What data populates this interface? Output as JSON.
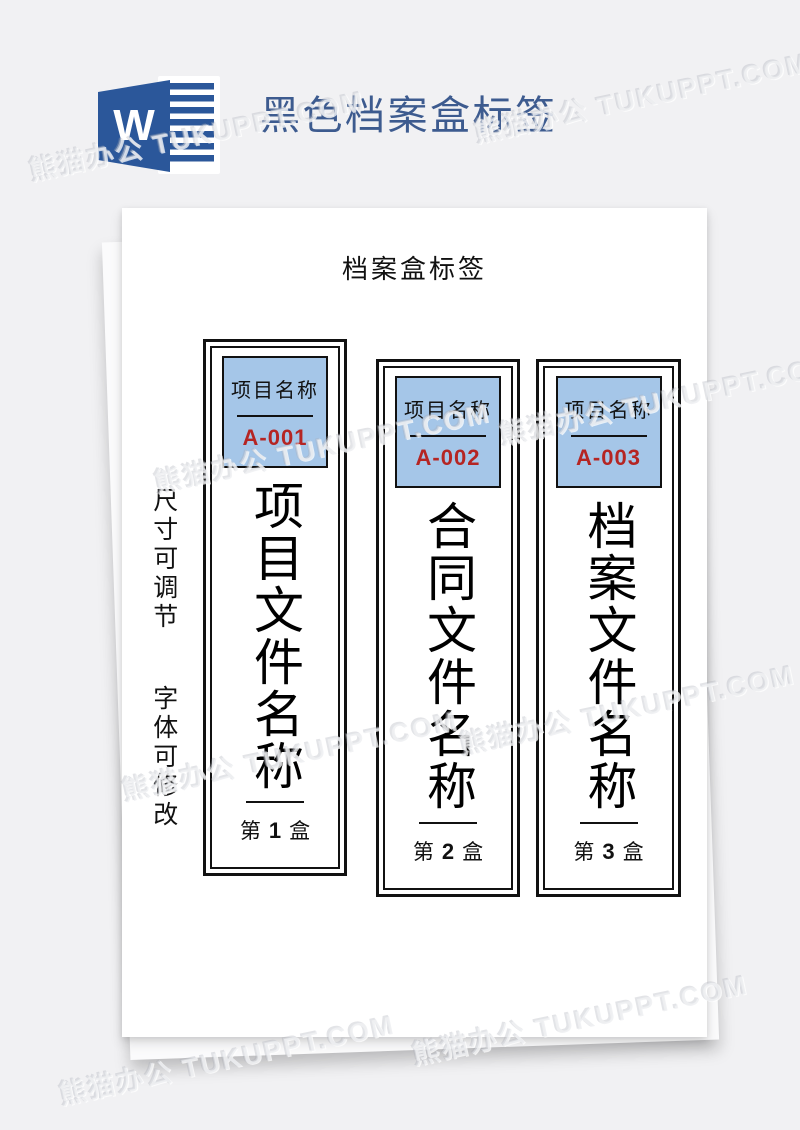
{
  "header": {
    "icon": "word-icon",
    "icon_letter": "W",
    "title": "黑色档案盒标签"
  },
  "watermark": {
    "text": "熊猫办公 TUKUPPT.COM",
    "instances": [
      {
        "x": 25,
        "y": 150,
        "rot": -12
      },
      {
        "x": 470,
        "y": 112,
        "rot": -12
      },
      {
        "x": 150,
        "y": 462,
        "rot": -12
      },
      {
        "x": 495,
        "y": 414,
        "rot": -12
      },
      {
        "x": 118,
        "y": 770,
        "rot": -12
      },
      {
        "x": 455,
        "y": 724,
        "rot": -12
      },
      {
        "x": 55,
        "y": 1074,
        "rot": -12
      },
      {
        "x": 408,
        "y": 1034,
        "rot": -12
      }
    ]
  },
  "document": {
    "page_title": "档案盒标签",
    "side_notes": [
      "尺寸可调节",
      "字体可修改"
    ],
    "labels": [
      {
        "header_title": "项目名称",
        "code": "A-001",
        "name": "项目文件名称",
        "box_prefix": "第",
        "box_number": "1",
        "box_suffix": "盒"
      },
      {
        "header_title": "项目名称",
        "code": "A-002",
        "name": "合同文件名称",
        "box_prefix": "第",
        "box_number": "2",
        "box_suffix": "盒"
      },
      {
        "header_title": "项目名称",
        "code": "A-003",
        "name": "档案文件名称",
        "box_prefix": "第",
        "box_number": "3",
        "box_suffix": "盒"
      }
    ]
  },
  "colors": {
    "background": "#f1f1f3",
    "paper": "#ffffff",
    "word_blue": "#2b579a",
    "title_blue": "#3d5b8f",
    "label_header_bg": "#a5c6e8",
    "code_red": "#b52523",
    "ink": "#141414"
  }
}
